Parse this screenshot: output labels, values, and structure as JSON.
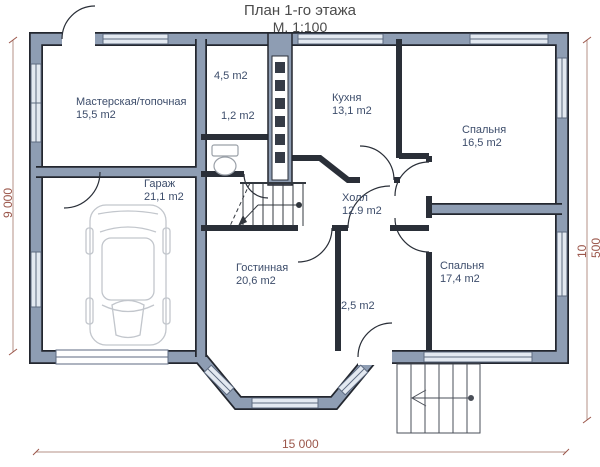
{
  "title": {
    "line1": "План 1-го этажа",
    "line2": "М. 1:100"
  },
  "rooms": [
    {
      "id": "workshop",
      "name": "Мастерская/топочная",
      "area": "15,5 m2"
    },
    {
      "id": "storage",
      "name": "",
      "area": "4,5 m2"
    },
    {
      "id": "wc",
      "name": "",
      "area": "1,2 m2"
    },
    {
      "id": "kitchen",
      "name": "Кухня",
      "area": "13,1 m2"
    },
    {
      "id": "bedroom-1",
      "name": "Спальня",
      "area": "16,5 m2"
    },
    {
      "id": "garage",
      "name": "Гараж",
      "area": "21,1 m2"
    },
    {
      "id": "hall",
      "name": "Холл",
      "area": "12.9 m2"
    },
    {
      "id": "living-room",
      "name": "Гостинная",
      "area": "20,6 m2"
    },
    {
      "id": "vestibule",
      "name": "",
      "area": "2,5 m2"
    },
    {
      "id": "bedroom-2",
      "name": "Спальня",
      "area": "17,4 m2"
    }
  ],
  "dimensions": {
    "left": "9 000",
    "right": "10 500",
    "bottom": "15 000"
  },
  "icons": {
    "car-icon": "top view car in garage",
    "toilet-icon": "toilet in wc",
    "staircase-icon": "internal stair with direction arrow",
    "entry-steps-icon": "exterior porch steps with arrow",
    "chimney-flues-icon": "stack of flue channels"
  },
  "colors": {
    "wall_fill": "#8e9db3",
    "wall_outline": "#23272f",
    "window_fill": "#e3e9f1",
    "window_frame": "#5d6a80",
    "label_text": "#3d4d6b",
    "dimension": "#9b564a",
    "title_text": "#4b4b4b"
  }
}
